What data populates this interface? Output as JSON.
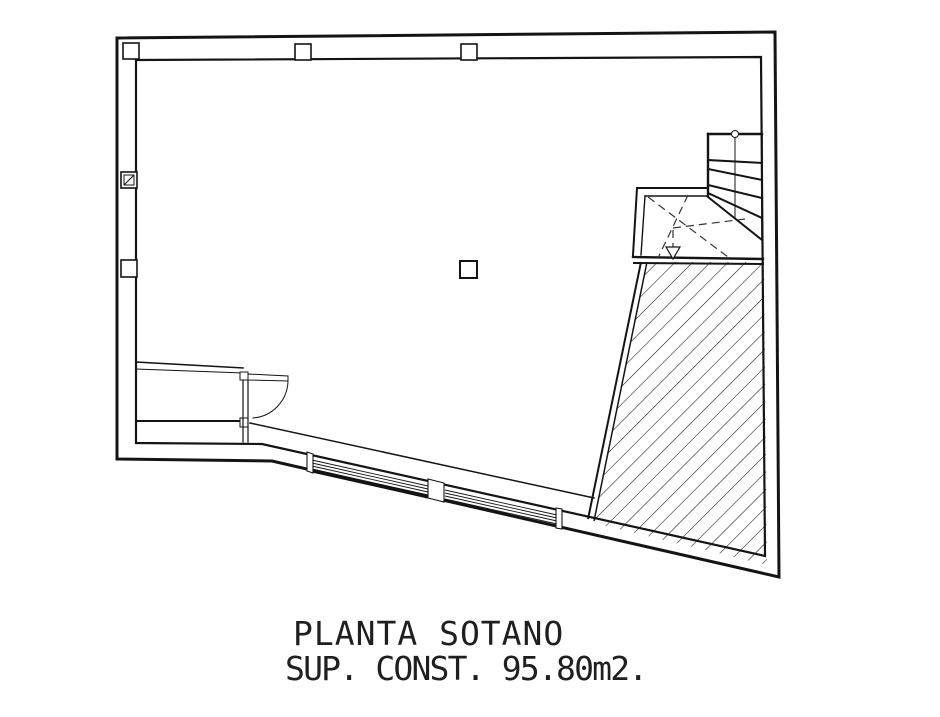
{
  "title_block": {
    "line1": "PLANTA SOTANO",
    "line2": "SUP. CONST. 95.80m2."
  },
  "colors": {
    "line": "#141414",
    "dashed_line": "#333333",
    "background": "#ffffff"
  }
}
